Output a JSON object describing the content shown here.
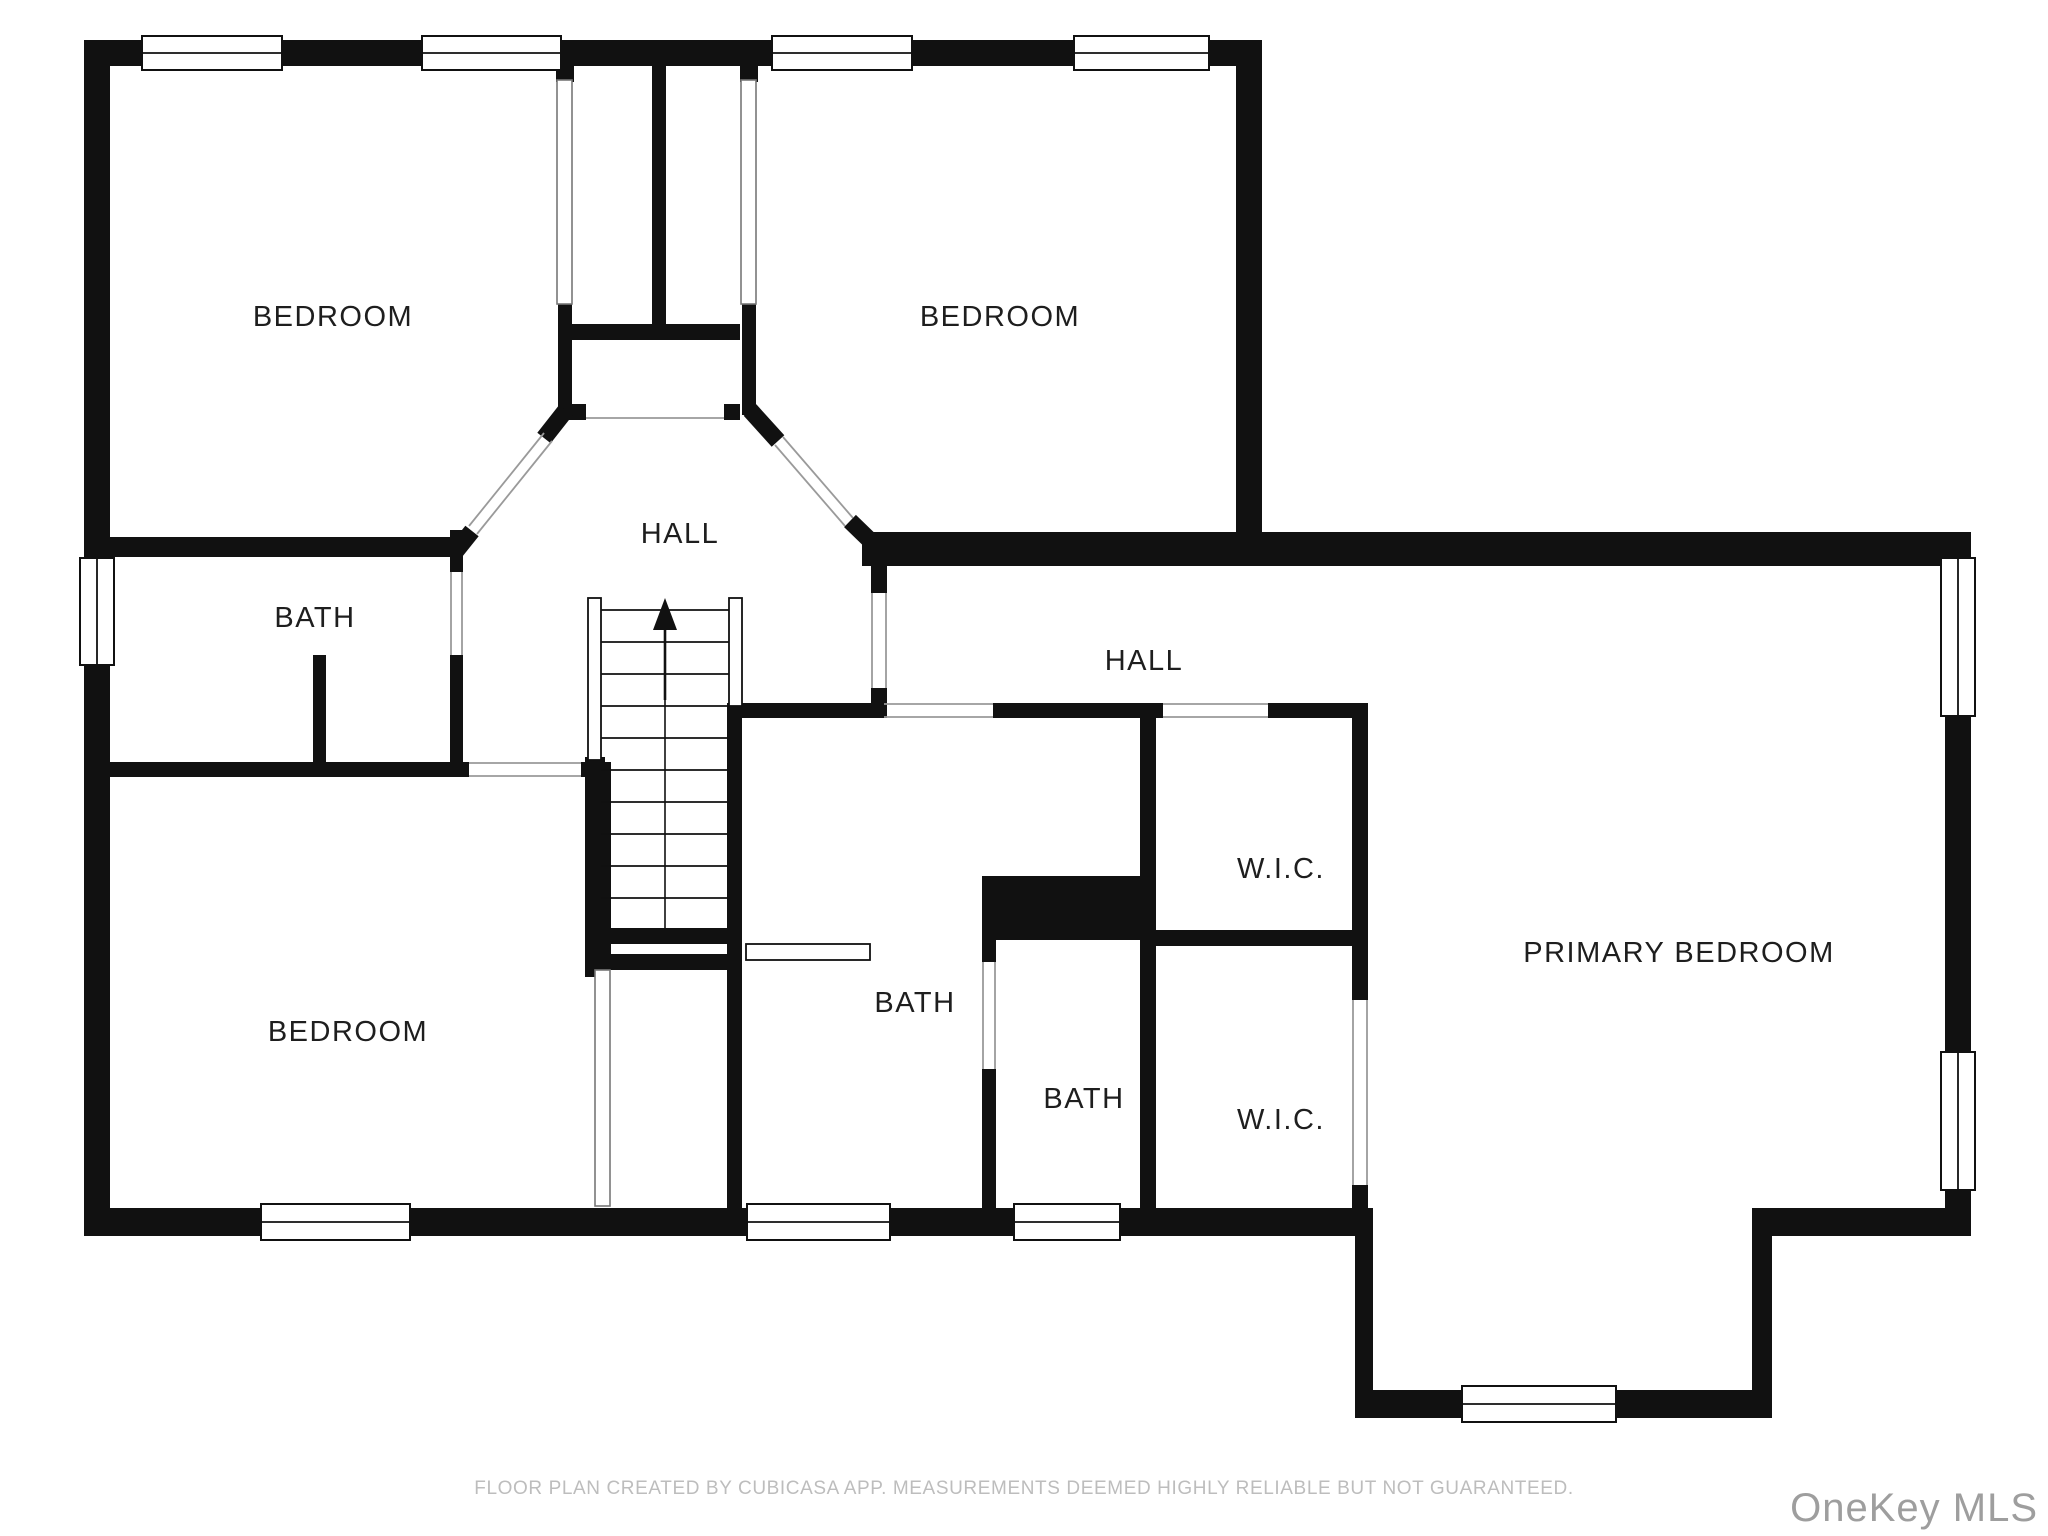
{
  "floor_plan": {
    "rooms": [
      {
        "id": "bedroom-top-left",
        "label": "BEDROOM"
      },
      {
        "id": "bedroom-top-right",
        "label": "BEDROOM"
      },
      {
        "id": "hall-center",
        "label": "HALL"
      },
      {
        "id": "bath-left",
        "label": "BATH"
      },
      {
        "id": "hall-right",
        "label": "HALL"
      },
      {
        "id": "wic-top",
        "label": "W.I.C."
      },
      {
        "id": "bath-center",
        "label": "BATH"
      },
      {
        "id": "bath-small",
        "label": "BATH"
      },
      {
        "id": "wic-bottom",
        "label": "W.I.C."
      },
      {
        "id": "primary-bedroom",
        "label": "PRIMARY BEDROOM"
      },
      {
        "id": "bedroom-bottom-left",
        "label": "BEDROOM"
      }
    ],
    "stairs": {
      "direction_icon": "up-arrow"
    },
    "window_count": 9,
    "colors": {
      "wall": "#111111",
      "background": "#ffffff",
      "room_fill": "#ffffff",
      "label_text": "#1e1e1e",
      "door_line": "#9a9a9a",
      "disclaimer_text": "#bdbdbd",
      "watermark_text": "#9e9e9e"
    }
  },
  "footer": {
    "disclaimer": "FLOOR PLAN CREATED BY CUBICASA APP. MEASUREMENTS DEEMED HIGHLY RELIABLE BUT NOT GUARANTEED."
  },
  "watermark": {
    "text": "OneKey MLS"
  }
}
